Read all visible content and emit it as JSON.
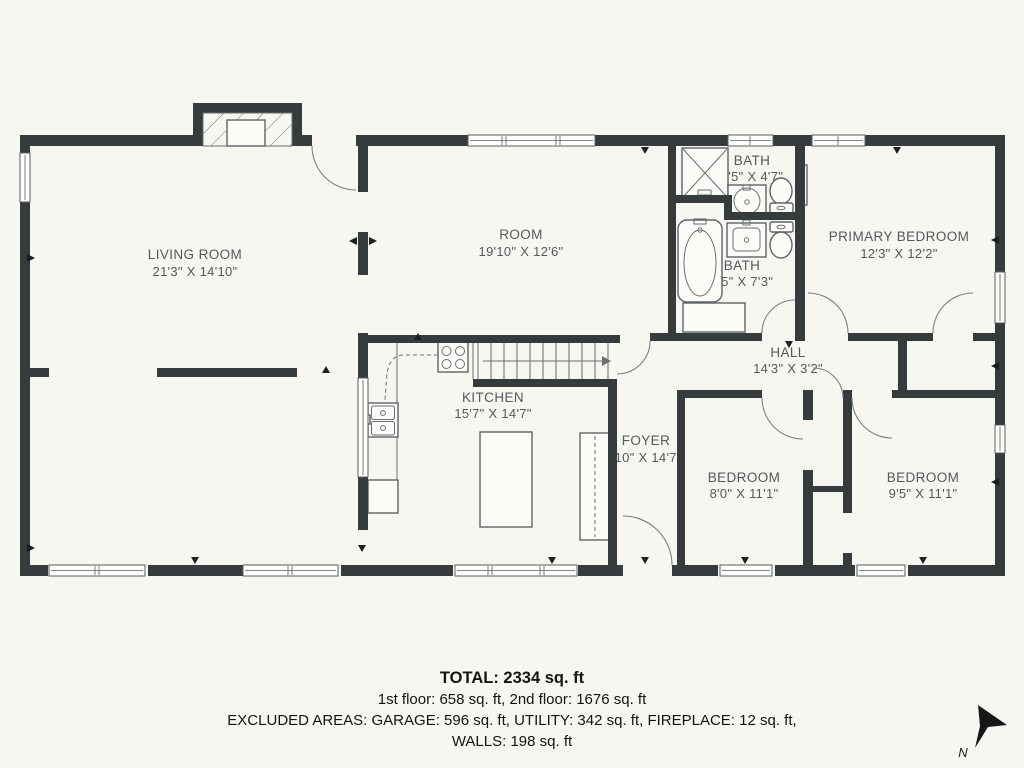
{
  "colors": {
    "background": "#f7f6f1",
    "wall": "#363b3e",
    "label": "#54595d",
    "footer_text": "#141414"
  },
  "rooms": {
    "living_room": {
      "name": "LIVING ROOM",
      "dims": "21'3\" X 14'10\""
    },
    "room": {
      "name": "ROOM",
      "dims": "19'10\" X 12'6\""
    },
    "bath_upper": {
      "name": "BATH",
      "dims": "7'5\" X 4'7\""
    },
    "bath_lower": {
      "name": "BATH",
      "dims": "7'5\" X 7'3\""
    },
    "primary_bedroom": {
      "name": "PRIMARY BEDROOM",
      "dims": "12'3\" X 12'2\""
    },
    "hall": {
      "name": "HALL",
      "dims": "14'3\" X 3'2\""
    },
    "kitchen": {
      "name": "KITCHEN",
      "dims": "15'7\" X 14'7\""
    },
    "foyer": {
      "name": "FOYER",
      "dims": "3'10\" X 14'7\""
    },
    "bedroom_left": {
      "name": "BEDROOM",
      "dims": "8'0\" X 11'1\""
    },
    "bedroom_right": {
      "name": "BEDROOM",
      "dims": "9'5\" X 11'1\""
    }
  },
  "footer": {
    "total": "TOTAL: 2334 sq. ft",
    "floors": "1st floor: 658 sq. ft, 2nd floor: 1676 sq. ft",
    "excluded": "EXCLUDED AREAS: GARAGE: 596 sq. ft, UTILITY: 342 sq. ft, FIREPLACE: 12 sq. ft,",
    "walls": "WALLS: 198 sq. ft"
  },
  "compass": {
    "label": "N"
  }
}
